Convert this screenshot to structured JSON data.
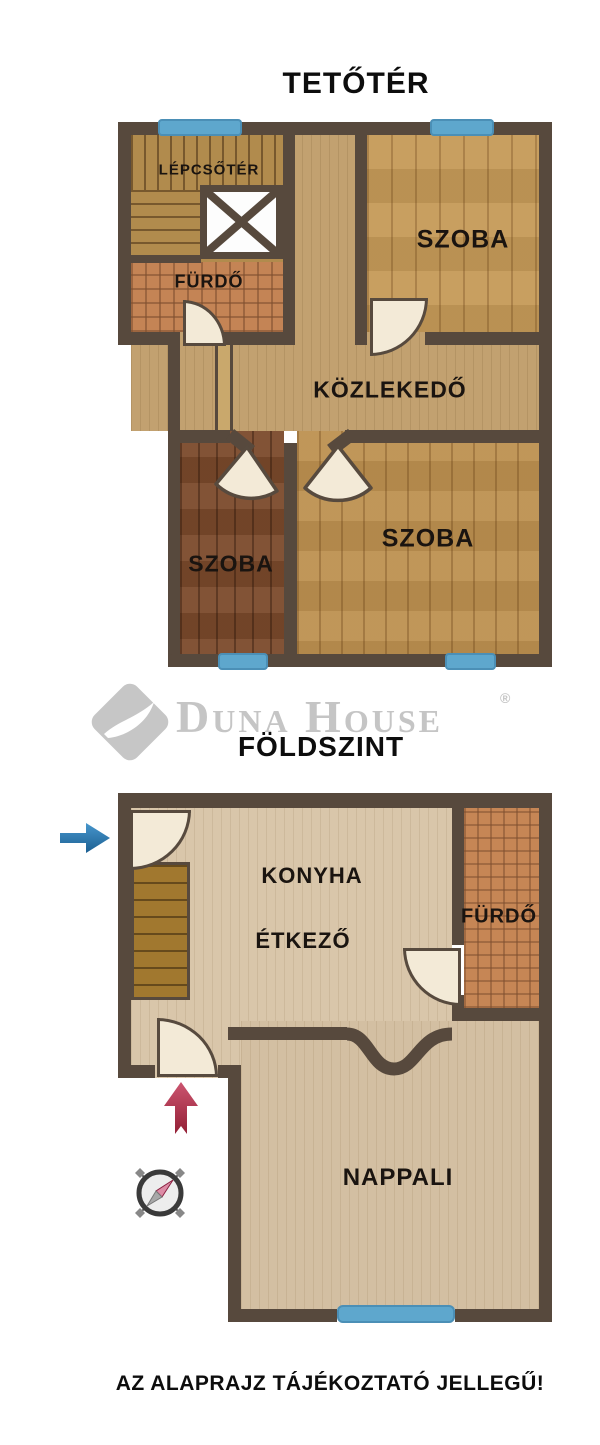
{
  "upper_floor": {
    "title": "TETŐTÉR",
    "rooms": {
      "stairwell": {
        "label": "LÉPCSŐTÉR"
      },
      "bathroom": {
        "label": "FÜRDŐ"
      },
      "hallway": {
        "label": "KÖZLEKEDŐ"
      },
      "room_top_right": {
        "label": "SZOBA"
      },
      "room_bottom_left": {
        "label": "SZOBA"
      },
      "room_bottom_right": {
        "label": "SZOBA"
      }
    }
  },
  "logo": {
    "brand": "Duna House",
    "registered": "®"
  },
  "ground_floor": {
    "title": "FÖLDSZINT",
    "rooms": {
      "kitchen": {
        "label": "KONYHA"
      },
      "dining": {
        "label": "ÉTKEZŐ"
      },
      "bathroom": {
        "label": "FÜRDŐ"
      },
      "living": {
        "label": "NAPPALI"
      }
    }
  },
  "footer": {
    "disclaimer": "AZ ALAPRAJZ TÁJÉKOZTATÓ JELLEGŰ!"
  },
  "icons": {
    "compass": "compass-rose",
    "entry_arrow_blue": "blue-right-arrow",
    "entry_arrow_red": "red-up-arrow",
    "void_marker": "x-void"
  },
  "colors": {
    "wall": "#57493d",
    "window": "#5ea7cd",
    "arrow_blue": "#2e81b8",
    "arrow_red": "#b83048",
    "door_fill": "#f3ead7",
    "logo_gray": "#c5c5c5"
  }
}
